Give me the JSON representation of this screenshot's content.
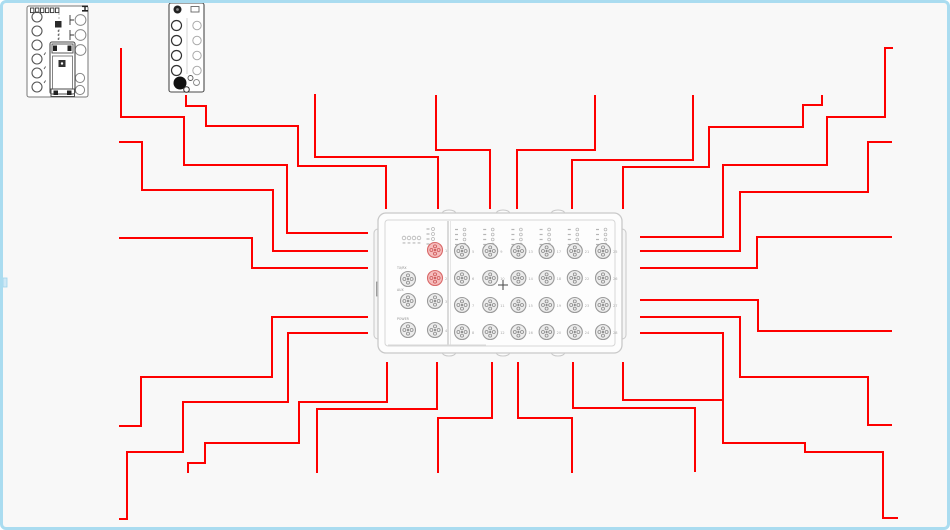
{
  "app": {
    "background": "#f8f8f8",
    "frame_border_color": "#aadcf0",
    "wire_color": "#fe0000",
    "wire_width": 2,
    "device_outline": "#c9c9c9",
    "device_fill": "#fdfdfd",
    "port_fill": "#ececec",
    "port_stroke": "#9a9a9a",
    "port_pin_color": "#8a8a8a",
    "highlight_port_fill": "#f6bcbc",
    "highlight_port_stroke": "#d96a6a",
    "highlight_pin_color": "#cc5555",
    "module_outline": "#4a4a4a",
    "led_color": "#b5b5b5",
    "label_color": "#909090",
    "number_color": "#a8a8a8",
    "crosshair_color": "#555555",
    "edge_handle_color": "#cfe9f6"
  },
  "wires": [
    {
      "id": "top-1",
      "points": [
        [
          186,
          95
        ],
        [
          186,
          106
        ],
        [
          206,
          106
        ],
        [
          206,
          126
        ],
        [
          298,
          126
        ],
        [
          298,
          166
        ],
        [
          386,
          166
        ],
        [
          386,
          209
        ]
      ]
    },
    {
      "id": "top-2",
      "points": [
        [
          315,
          94
        ],
        [
          315,
          157
        ],
        [
          438,
          157
        ],
        [
          438,
          209
        ]
      ]
    },
    {
      "id": "top-3",
      "points": [
        [
          436,
          95
        ],
        [
          436,
          150
        ],
        [
          490,
          150
        ],
        [
          490,
          209
        ]
      ]
    },
    {
      "id": "top-4",
      "points": [
        [
          595,
          95
        ],
        [
          595,
          150
        ],
        [
          517,
          150
        ],
        [
          517,
          209
        ]
      ]
    },
    {
      "id": "top-5",
      "points": [
        [
          693,
          95
        ],
        [
          693,
          160
        ],
        [
          572,
          160
        ],
        [
          572,
          209
        ]
      ]
    },
    {
      "id": "top-6",
      "points": [
        [
          822,
          95
        ],
        [
          822,
          105
        ],
        [
          803,
          105
        ],
        [
          803,
          127
        ],
        [
          709,
          127
        ],
        [
          709,
          167
        ],
        [
          623,
          167
        ],
        [
          623,
          209
        ]
      ]
    },
    {
      "id": "left-1",
      "points": [
        [
          121,
          48
        ],
        [
          121,
          117
        ],
        [
          184,
          117
        ],
        [
          184,
          165
        ],
        [
          287,
          165
        ],
        [
          287,
          233
        ],
        [
          368,
          233
        ]
      ]
    },
    {
      "id": "left-2",
      "points": [
        [
          119,
          142
        ],
        [
          142,
          142
        ],
        [
          142,
          190
        ],
        [
          273,
          190
        ],
        [
          273,
          251
        ],
        [
          368,
          251
        ]
      ]
    },
    {
      "id": "left-3",
      "points": [
        [
          119,
          238
        ],
        [
          252,
          238
        ],
        [
          252,
          268
        ],
        [
          368,
          268
        ]
      ]
    },
    {
      "id": "left-4",
      "points": [
        [
          119,
          426
        ],
        [
          141,
          426
        ],
        [
          141,
          377
        ],
        [
          272,
          377
        ],
        [
          272,
          317
        ],
        [
          368,
          317
        ]
      ]
    },
    {
      "id": "left-5",
      "points": [
        [
          119,
          519
        ],
        [
          127,
          519
        ],
        [
          127,
          452
        ],
        [
          183,
          452
        ],
        [
          183,
          402
        ],
        [
          288,
          402
        ],
        [
          288,
          333
        ],
        [
          368,
          333
        ]
      ]
    },
    {
      "id": "right-1",
      "points": [
        [
          640,
          237
        ],
        [
          723,
          237
        ],
        [
          723,
          165
        ],
        [
          827,
          165
        ],
        [
          827,
          117
        ],
        [
          885,
          117
        ],
        [
          885,
          48
        ],
        [
          893,
          48
        ]
      ]
    },
    {
      "id": "right-2",
      "points": [
        [
          640,
          251
        ],
        [
          740,
          251
        ],
        [
          740,
          192
        ],
        [
          868,
          192
        ],
        [
          868,
          142
        ],
        [
          892,
          142
        ]
      ]
    },
    {
      "id": "right-3",
      "points": [
        [
          640,
          268
        ],
        [
          757,
          268
        ],
        [
          757,
          237
        ],
        [
          892,
          237
        ]
      ]
    },
    {
      "id": "right-4",
      "points": [
        [
          640,
          300
        ],
        [
          758,
          300
        ],
        [
          758,
          331
        ],
        [
          892,
          331
        ]
      ]
    },
    {
      "id": "right-5",
      "points": [
        [
          640,
          317
        ],
        [
          740,
          317
        ],
        [
          740,
          377
        ],
        [
          868,
          377
        ],
        [
          868,
          425
        ],
        [
          892,
          425
        ]
      ]
    },
    {
      "id": "right-6",
      "points": [
        [
          640,
          333
        ],
        [
          723,
          333
        ],
        [
          723,
          443
        ],
        [
          805,
          443
        ],
        [
          805,
          452
        ],
        [
          883,
          452
        ],
        [
          883,
          518
        ],
        [
          898,
          518
        ]
      ]
    },
    {
      "id": "bottom-1",
      "points": [
        [
          387,
          362
        ],
        [
          387,
          402
        ],
        [
          299,
          402
        ],
        [
          299,
          443
        ],
        [
          205,
          443
        ],
        [
          205,
          463
        ],
        [
          188,
          463
        ],
        [
          188,
          473
        ]
      ]
    },
    {
      "id": "bottom-2",
      "points": [
        [
          437,
          362
        ],
        [
          437,
          409
        ],
        [
          317,
          409
        ],
        [
          317,
          473
        ]
      ]
    },
    {
      "id": "bottom-3",
      "points": [
        [
          492,
          362
        ],
        [
          492,
          418
        ],
        [
          438,
          418
        ],
        [
          438,
          473
        ]
      ]
    },
    {
      "id": "bottom-4",
      "points": [
        [
          518,
          362
        ],
        [
          518,
          418
        ],
        [
          572,
          418
        ],
        [
          572,
          473
        ]
      ]
    },
    {
      "id": "bottom-5",
      "points": [
        [
          573,
          362
        ],
        [
          573,
          408
        ],
        [
          695,
          408
        ],
        [
          695,
          472
        ]
      ]
    },
    {
      "id": "bottom-6",
      "points": [
        [
          623,
          362
        ],
        [
          623,
          400
        ],
        [
          722,
          400
        ]
      ]
    }
  ],
  "central_device": {
    "x": 378,
    "y": 213,
    "w": 244,
    "h": 140,
    "divider_x": 448,
    "tab_xs": [
      449,
      503,
      558
    ],
    "left_ports": [
      {
        "x": 408,
        "y": 279,
        "label": "TX/RX"
      },
      {
        "x": 408,
        "y": 301,
        "label": "AUX"
      },
      {
        "x": 408,
        "y": 330,
        "label": "POWER"
      }
    ],
    "mid_ports": [
      {
        "x": 435,
        "y": 250,
        "num": "1",
        "highlight": true
      },
      {
        "x": 435,
        "y": 278,
        "num": "2",
        "highlight": true
      },
      {
        "x": 435,
        "y": 301,
        "num": "3",
        "highlight": false
      },
      {
        "x": 435,
        "y": 330,
        "num": "4",
        "highlight": false
      }
    ],
    "grid": {
      "cols": [
        462,
        490.2,
        518.4,
        546.6,
        574.8,
        603
      ],
      "rows": [
        251,
        278,
        305,
        332
      ],
      "numbers": [
        "5",
        "6",
        "7",
        "8",
        "9",
        "10",
        "11",
        "12",
        "13",
        "14",
        "15",
        "16",
        "17",
        "18",
        "19",
        "20",
        "21",
        "22",
        "23",
        "24",
        "25",
        "26",
        "27",
        "28"
      ]
    },
    "crosshair": {
      "x": 503,
      "y": 285
    }
  },
  "modules": [
    {
      "id": "module-a",
      "x": 27,
      "y": 6,
      "w": 61,
      "h": 91
    },
    {
      "id": "module-b",
      "x": 169,
      "y": 3,
      "w": 35,
      "h": 89
    }
  ]
}
